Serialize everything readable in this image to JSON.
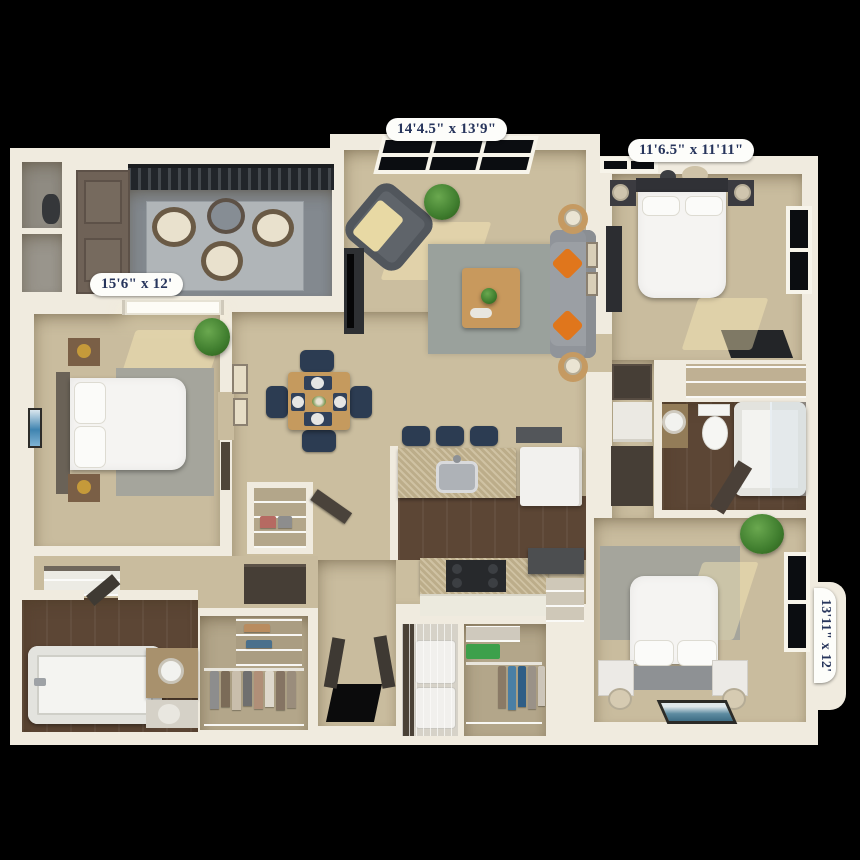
{
  "scene": {
    "type": "3d-floor-plan-top-down-render",
    "background": "#000000",
    "unit": "2-3 bedroom apartment"
  },
  "labels": {
    "living_room": {
      "text": "14'4.5\" x 13'9\"",
      "position": "top-center"
    },
    "bedroom_top_right": {
      "text": "11'6.5\" x 11'11\"",
      "position": "top-right"
    },
    "bedroom_left": {
      "text": "15'6\" x 12'",
      "position": "left"
    },
    "bedroom_bottom_right": {
      "text": "13'11\" x 12'",
      "position": "right-rotated"
    }
  },
  "palette": {
    "wall": "#f0ebdf",
    "carpet": "#cbbe9f",
    "carpet2": "#c9bc9e",
    "wood": "#5c4635",
    "rug": "#9aa19c",
    "rugGray": "#a5a59c",
    "patio": "#83898f",
    "patioRug": "#b0b5b8",
    "navy": "#2c3c52",
    "orange": "#e0761c",
    "counter": "#c6b691",
    "white": "#f4f3f0",
    "bedWhite": "#f5f4f2",
    "doorBrown": "#6f6257",
    "cabinetDark": "#463e36",
    "closetTan": "#b3a68a",
    "labelText": "#27355c",
    "labelBg": "#fdfdfa",
    "plant": "#3f7d2e",
    "gold": "#c59a3a"
  },
  "rooms": [
    {
      "name": "patio",
      "items": [
        "railing",
        "lounge-chairs-3",
        "round-table",
        "outdoor-rug"
      ]
    },
    {
      "name": "storage-closets-left",
      "items": [
        "double-brown-doors",
        "water-heater",
        "utility-cubbies-2"
      ]
    },
    {
      "name": "living-room",
      "items": [
        "window",
        "armchair",
        "throw-blanket",
        "floor-plant",
        "tv-console",
        "area-rug",
        "coffee-table",
        "sofa",
        "orange-pillows-2",
        "side-tables-2",
        "table-lamps-2",
        "wall-frames"
      ]
    },
    {
      "name": "dining-area",
      "items": [
        "square-table",
        "navy-chairs-4",
        "place-settings-4",
        "centerpiece"
      ]
    },
    {
      "name": "kitchen",
      "items": [
        "breakfast-bar",
        "bar-stools-3",
        "sink",
        "refrigerator",
        "range",
        "white-cabinets",
        "pantry-shelves"
      ]
    },
    {
      "name": "bedroom-top-right",
      "items": [
        "bed",
        "pillows-2",
        "nightstands-2",
        "lamps-2",
        "dresser",
        "desk",
        "windows-2",
        "ceiling-light"
      ]
    },
    {
      "name": "bedroom-left",
      "items": [
        "bed",
        "pillows-2",
        "nightstands-2",
        "gold-lamps-2",
        "area-rug",
        "wall-art",
        "plant",
        "sunlit-window"
      ]
    },
    {
      "name": "bedroom-bottom-right",
      "items": [
        "bed",
        "pillows-2",
        "nightstands-2",
        "tipped-lamps-2",
        "area-rug",
        "floor-art",
        "plant",
        "window"
      ]
    },
    {
      "name": "bathroom-left",
      "items": [
        "bathtub",
        "vanity-sink",
        "mirror-reflection",
        "door",
        "linen-closet-wire-shelves"
      ]
    },
    {
      "name": "bathroom-right",
      "items": [
        "tub-shower",
        "glass-enclosure",
        "toilet",
        "vessel-sink",
        "door",
        "wire-shelf-closet"
      ]
    },
    {
      "name": "walk-in-closet-bottom-left",
      "items": [
        "wire-shelves",
        "hanging-clothes",
        "folded-stacks"
      ]
    },
    {
      "name": "walk-in-closet-bottom-center",
      "items": [
        "wire-shelves",
        "hanging-clothes",
        "green-bin"
      ]
    },
    {
      "name": "laundry-closet",
      "items": [
        "washer",
        "dryer",
        "wire-door"
      ]
    },
    {
      "name": "entry",
      "items": [
        "double-doors",
        "black-door-mat"
      ]
    },
    {
      "name": "hallways",
      "items": [
        "wall-frames",
        "dark-cabinets",
        "small-closet",
        "appliance-nook"
      ]
    }
  ]
}
